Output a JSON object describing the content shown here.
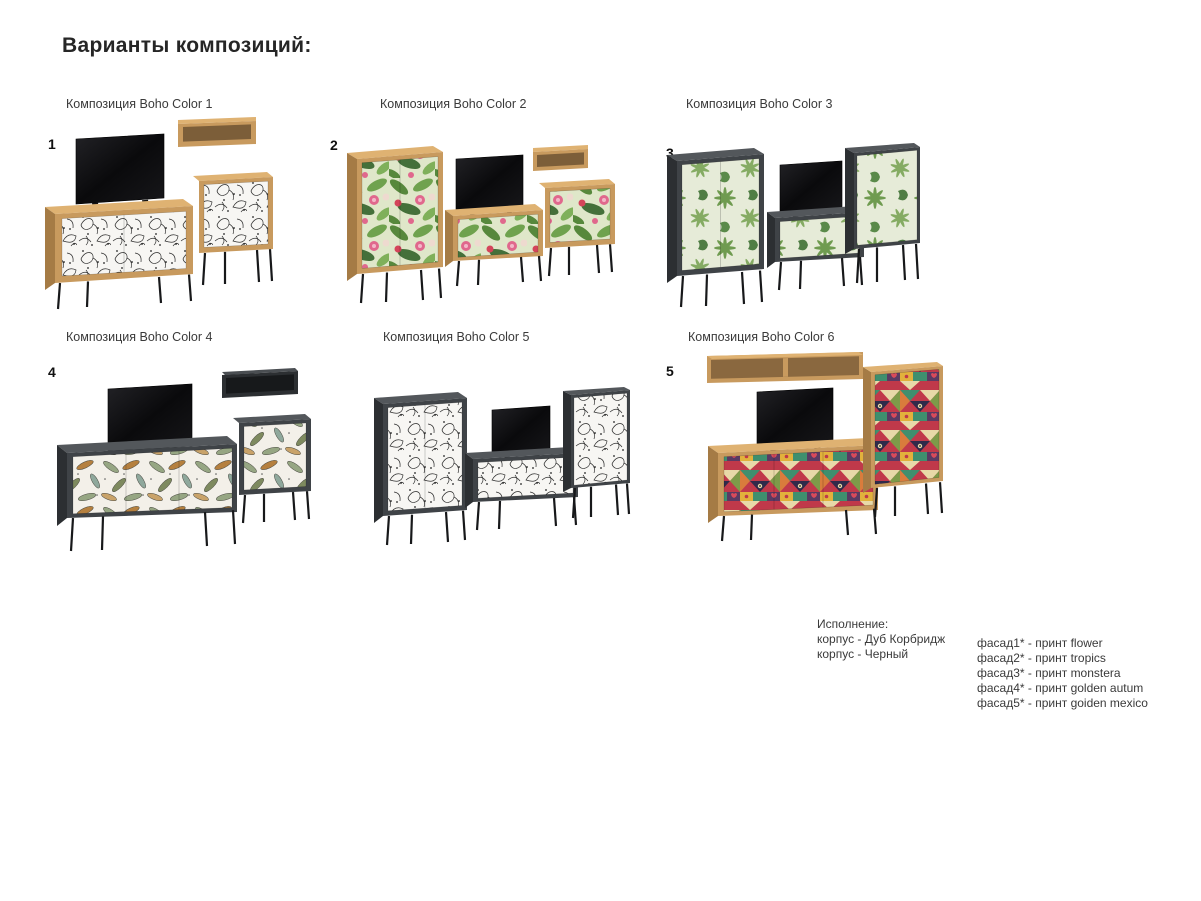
{
  "page": {
    "title": "Варианты композиций:"
  },
  "compositions": [
    {
      "number": "1",
      "label": "Композиция Boho Color 1"
    },
    {
      "number": "2",
      "label": "Композиция Boho Color 2"
    },
    {
      "number": "3",
      "label": "Композиция Boho Color 3"
    },
    {
      "number": "4",
      "label": "Композиция Boho Color 4"
    },
    {
      "number": "",
      "label": "Композиция Boho Color 5"
    },
    {
      "number": "5",
      "label": "Композиция Boho Color 6"
    }
  ],
  "legend": {
    "title": "Исполнение:",
    "body_options": [
      "корпус - Дуб Корбридж",
      "корпус - Черный"
    ],
    "facade_options": [
      "фасад1* - принт flower",
      "фасад2* - принт tropics",
      "фасад3* - принт monstera",
      "фасад4* - принт golden autum",
      "фасад5* - принт goiden mexico"
    ]
  },
  "colors": {
    "oak": "#c89a5e",
    "graphite": "#3f4347",
    "print_flower_bg": "#f7f6f3",
    "print_tropics_green": "#57883c",
    "print_monstera_green": "#6f9b50",
    "print_autumn_caramel": "#b5803f",
    "print_mexico_red": "#c0394a"
  }
}
